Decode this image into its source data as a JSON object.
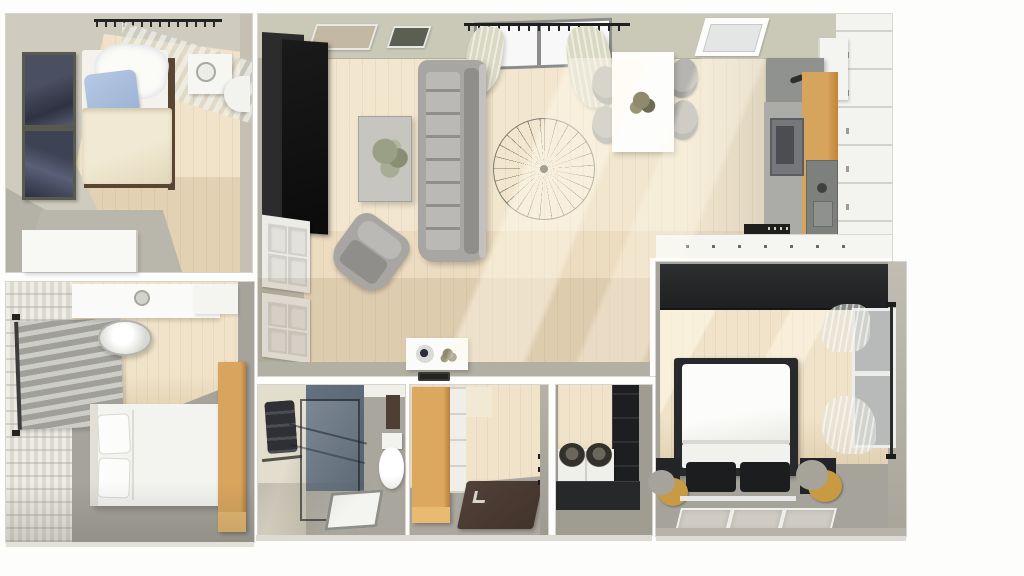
{
  "scene": {
    "description": "3D rendered apartment floor plan, top-down axonometric view, no visible text",
    "view": "top-down interior render",
    "visible_text": ""
  },
  "palette": {
    "bg": "#fdfdfb",
    "wall": "#cac8b7",
    "wall-beige": "#cfccbf",
    "wall-gray": "#b2afa3",
    "wall-dark": "#9d9a90",
    "white": "#f5f5f1",
    "wood": "#f0e3c9",
    "wood-dark": "#e2d1b2",
    "plank": "rgba(120,95,55,0.08)",
    "carpet": "#a6a39b",
    "carpet-dark": "#93908a",
    "black": "#1d1e20",
    "sofa": "#a7a6a2",
    "sofa-dark": "#8f8e8a",
    "sofa-light": "#bab9b5",
    "chair": "#b5b4b0",
    "duvet": "#ece3cb",
    "pillow-blue": "#aabfdd",
    "art": "#3e4252",
    "cab-wood": "#d09a54",
    "cab-wood-dark": "#b87f3e",
    "blue-wall": "#5d6b7a",
    "mat": "#4a3a30",
    "gold": "#c79a43",
    "curtain": "#d9d8c3",
    "blind-a": "#cdcdc8",
    "blind-b": "#a0a099",
    "glass-edge": "rgba(28,30,34,0.65)",
    "shadow": "rgba(150,125,88,0.16)",
    "sun": "rgba(255,250,236,0.45)"
  },
  "rooms": [
    {
      "id": "bedroom-top-left",
      "name": "Bedroom (top left)",
      "furniture": [
        "double bed",
        "blue pillow",
        "white blanket",
        "nightstand with lamp",
        "white dresser",
        "two dark wall artworks",
        "curtain rod with sheer curtain",
        "white stool"
      ]
    },
    {
      "id": "bedroom-bottom-left",
      "name": "Bedroom (bottom left)",
      "furniture": [
        "bed with two pillows",
        "white vanity desk",
        "round stool",
        "window blinds",
        "tall wooden wardrobe",
        "paneled accent wall"
      ]
    },
    {
      "id": "living-room",
      "name": "Living room",
      "furniture": [
        "black TV wall unit",
        "white closet doors",
        "gray tufted sofa",
        "coffee table with plant",
        "armchair",
        "wire chandelier",
        "console table with bowl and plant",
        "dark tray",
        "large window with tied curtains",
        "two wall frames"
      ]
    },
    {
      "id": "dining-area",
      "name": "Dining area",
      "furniture": [
        "white dining table",
        "four gray chairs",
        "plant centerpiece"
      ]
    },
    {
      "id": "kitchen",
      "name": "Kitchen",
      "furniture": [
        "skylight",
        "gray upper cabinet",
        "tall white cabinet wall",
        "base cabinets",
        "wood countertop",
        "oven",
        "sink unit",
        "island counter",
        "dark cooktop strip"
      ]
    },
    {
      "id": "bathroom",
      "name": "Bathroom",
      "furniture": [
        "glass walk-in shower",
        "white shower tray",
        "toilet",
        "dark towels on rack",
        "blue accent wall"
      ]
    },
    {
      "id": "entry-hall",
      "name": "Entry hall",
      "furniture": [
        "tall wooden wardrobe",
        "white shelving",
        "dark brown door mat",
        "door hinges"
      ]
    },
    {
      "id": "pantry",
      "name": "Laundry / pantry closet",
      "furniture": [
        "black shelving unit",
        "white drawer unit",
        "two round baskets"
      ]
    },
    {
      "id": "bedroom-bottom-right",
      "name": "Bedroom (bottom right)",
      "furniture": [
        "bed with black headboard frame",
        "two black pillows",
        "two black nightstands",
        "gold crescent sconce lamps",
        "white bench",
        "three floor rugs",
        "dark full-width wardrobe",
        "window with sheer curtains"
      ]
    }
  ]
}
